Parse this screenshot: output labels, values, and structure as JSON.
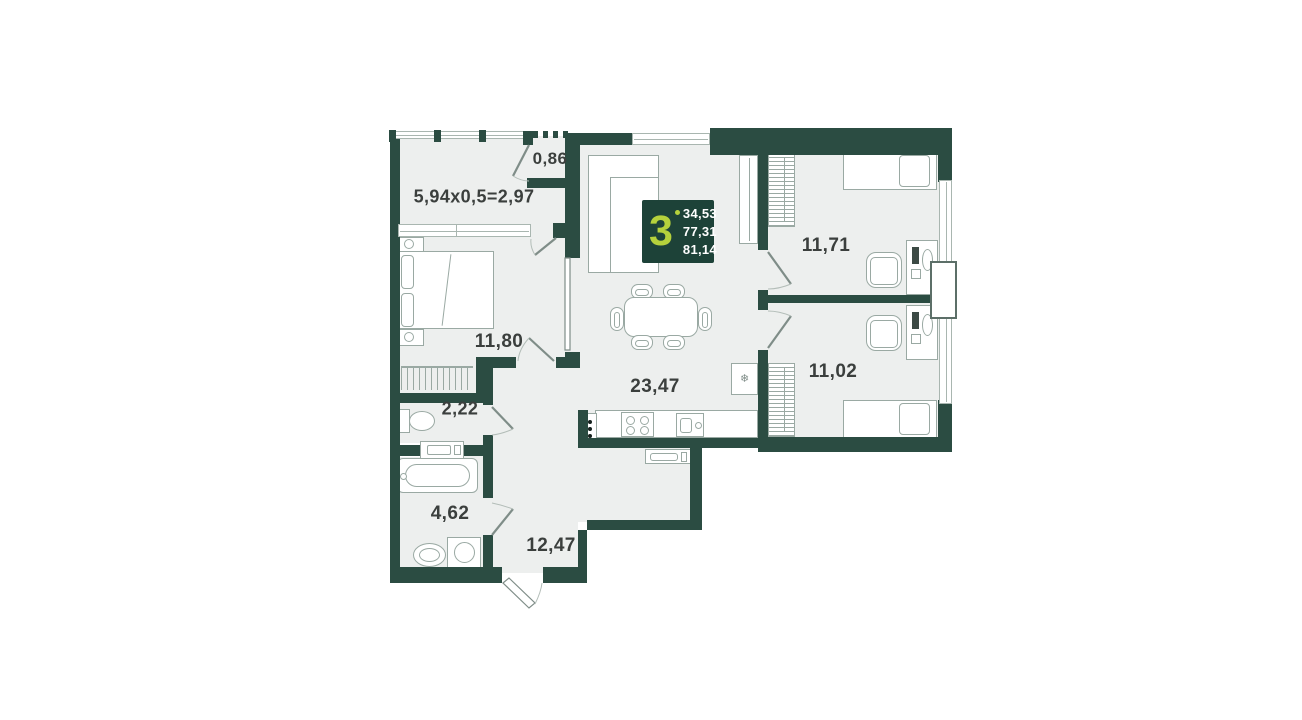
{
  "plan": {
    "rooms": [
      {
        "id": "loggia",
        "label": "5,94x0,5=2,97"
      },
      {
        "id": "pantry",
        "label": "0,86"
      },
      {
        "id": "bedroom",
        "label": "11,80"
      },
      {
        "id": "wc",
        "label": "2,22"
      },
      {
        "id": "bathroom",
        "label": "4,62"
      },
      {
        "id": "hallway",
        "label": "12,47"
      },
      {
        "id": "living-kitchen",
        "label": "23,47"
      },
      {
        "id": "bedroom-2",
        "label": "11,71"
      },
      {
        "id": "bedroom-3",
        "label": "11,02"
      }
    ],
    "badge": {
      "rooms": "3",
      "values": [
        "34,53",
        "77,31",
        "81,14"
      ]
    },
    "colors": {
      "wall": "#2b4c42",
      "floor": "#edefee",
      "accent": "#b5d13c",
      "badge_bg": "#1d4238",
      "label_text": "#3b3f3d",
      "line": "#9aa9a3"
    },
    "furniture": [
      "corner-sofa",
      "dining-table",
      "dining-chair",
      "kitchen-counter",
      "stove",
      "kitchen-sink",
      "fridge",
      "double-bed",
      "nightstand",
      "single-bed",
      "wardrobe",
      "desk",
      "office-chair",
      "radiator",
      "toilet",
      "bathtub",
      "washing-machine",
      "pedestal-sink",
      "air-conditioner"
    ]
  }
}
